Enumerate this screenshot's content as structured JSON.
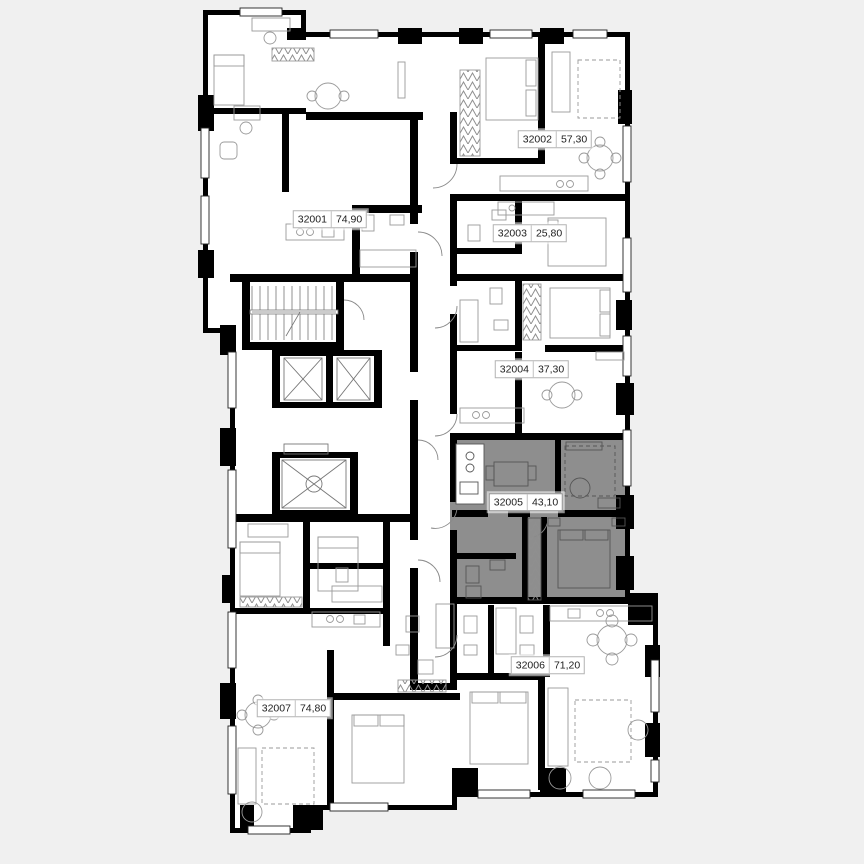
{
  "plan": {
    "type": "residential-floor-plan",
    "highlighted_apartment": "32005",
    "apartments": [
      {
        "id": "32001",
        "area": "74,90",
        "highlighted": false
      },
      {
        "id": "32002",
        "area": "57,30",
        "highlighted": false
      },
      {
        "id": "32003",
        "area": "25,80",
        "highlighted": false
      },
      {
        "id": "32004",
        "area": "37,30",
        "highlighted": false
      },
      {
        "id": "32005",
        "area": "43,10",
        "highlighted": true
      },
      {
        "id": "32006",
        "area": "71,20",
        "highlighted": false
      },
      {
        "id": "32007",
        "area": "74,80",
        "highlighted": false
      }
    ],
    "colors": {
      "background": "#f0f0f0",
      "floor": "#ffffff",
      "walls": "#000000",
      "highlight_fill": "#8e8e8e",
      "furniture_stroke": "#9a9a9a",
      "label_background": "#ffffff",
      "label_border": "#b3b3b3",
      "label_text": "#1d1d1d"
    }
  }
}
